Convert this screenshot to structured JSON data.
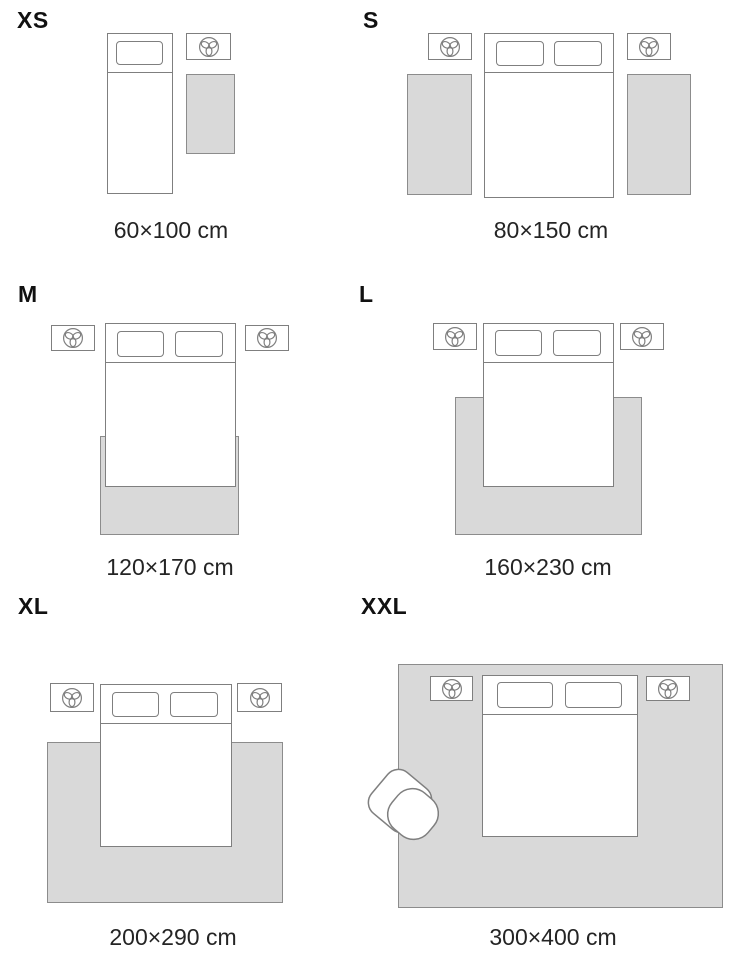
{
  "guide": {
    "sizes": [
      {
        "id": "xs",
        "label": "XS",
        "dimensions": "60×100 cm"
      },
      {
        "id": "s",
        "label": "S",
        "dimensions": "80×150 cm"
      },
      {
        "id": "m",
        "label": "M",
        "dimensions": "120×170 cm"
      },
      {
        "id": "l",
        "label": "L",
        "dimensions": "160×230 cm"
      },
      {
        "id": "xl",
        "label": "XL",
        "dimensions": "200×290 cm"
      },
      {
        "id": "xxl",
        "label": "XXL",
        "dimensions": "300×400 cm"
      }
    ]
  },
  "colors": {
    "rug_fill": "#d9d9d9",
    "rug_border": "#8c8c8c",
    "furniture_outline": "#7f7f7f",
    "text": "#1d1d1d",
    "background": "#ffffff"
  },
  "icons": {
    "nightstand_lamp": "lamp-icon",
    "armchair": "armchair"
  }
}
